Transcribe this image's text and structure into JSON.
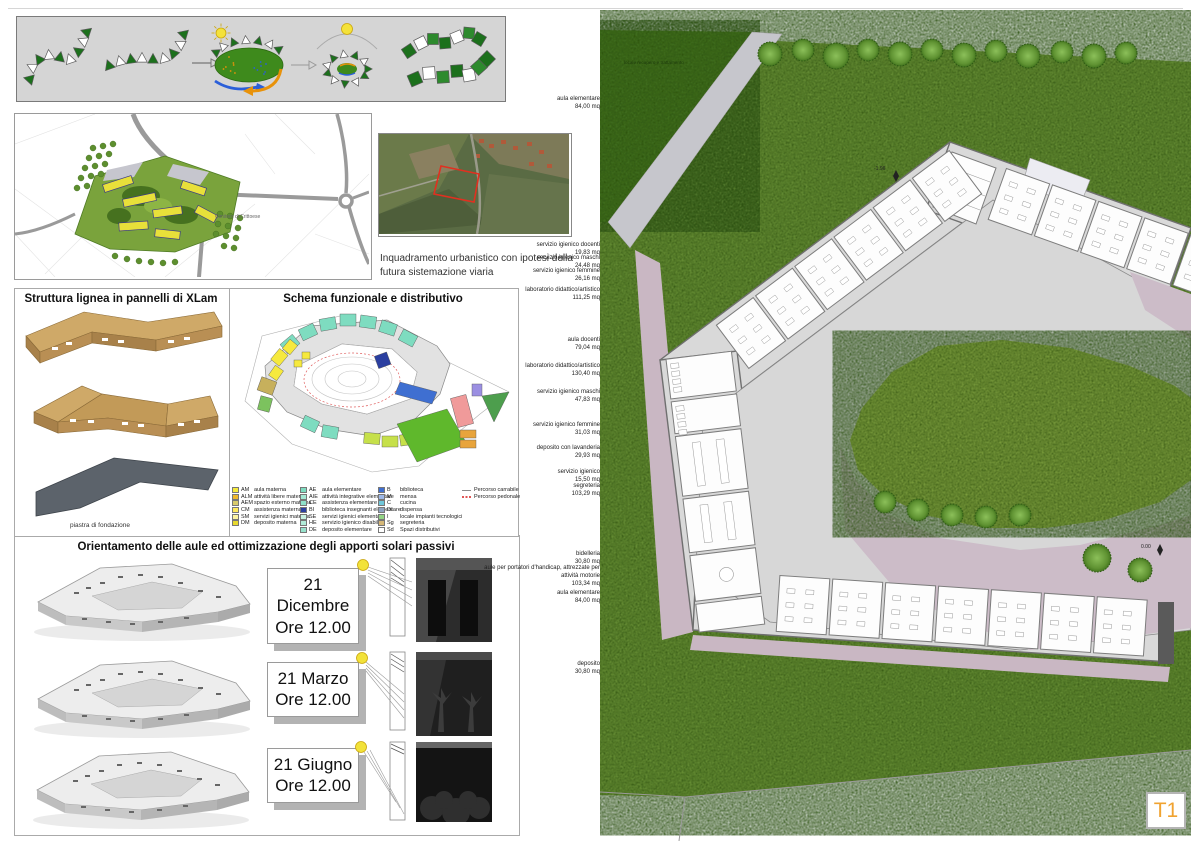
{
  "sheet": {
    "code": "T1"
  },
  "urban_map": {
    "place_label": "Cimitero di Crittoese"
  },
  "satellite": {
    "caption": "Inquadramento urbanistico con ipotesi della futura sistemazione viaria"
  },
  "xlam": {
    "title": "Struttura lignea in pannelli di XLam",
    "foundation_label": "piastra di fondazione"
  },
  "schema": {
    "title": "Schema funzionale e distributivo",
    "legend": {
      "materna": [
        {
          "code": "AM",
          "label": "aula materna",
          "color": "#f6ea3d"
        },
        {
          "code": "ALM",
          "label": "attività libere materna",
          "color": "#f0b92c"
        },
        {
          "code": "AEM",
          "label": "spazio esterno materna",
          "color": "#d9ca6a"
        },
        {
          "code": "CM",
          "label": "assistenza materna",
          "color": "#ffe95e"
        },
        {
          "code": "SM",
          "label": "servizi igienici materna",
          "color": "#fdf4a0"
        },
        {
          "code": "DM",
          "label": "deposito materna",
          "color": "#e8d92e"
        }
      ],
      "elementare": [
        {
          "code": "AE",
          "label": "aula elementare",
          "color": "#7edcc0"
        },
        {
          "code": "AIE",
          "label": "attività integrative elementare",
          "color": "#a5e8d4"
        },
        {
          "code": "CE",
          "label": "assistenza elementare",
          "color": "#8fe0c9"
        },
        {
          "code": "BI",
          "label": "biblioteca insegnanti elementare",
          "color": "#2b3fa0"
        },
        {
          "code": "SE",
          "label": "servizi igienici elementare",
          "color": "#c6f0e0"
        },
        {
          "code": "HE",
          "label": "servizio igienico disabile",
          "color": "#b2ecd9"
        },
        {
          "code": "DE",
          "label": "deposito elementare",
          "color": "#96e2cc"
        }
      ],
      "servizi": [
        {
          "code": "B",
          "label": "biblioteca",
          "color": "#3f6fd1"
        },
        {
          "code": "M",
          "label": "mensa",
          "color": "#9db8e8"
        },
        {
          "code": "C",
          "label": "cucina",
          "color": "#6fc6d9"
        },
        {
          "code": "Di",
          "label": "dispensa",
          "color": "#8fa3c0"
        },
        {
          "code": "I",
          "label": "locale impianti tecnologici",
          "color": "#92d483"
        },
        {
          "code": "Sg",
          "label": "segreteria",
          "color": "#d6b878"
        },
        {
          "code": "Sd",
          "label": "Spazi distributivi",
          "color": "#ffffff"
        }
      ],
      "percorsi": [
        {
          "label": "Percorso carrabile",
          "style": "solid",
          "color": "#8a8a8a"
        },
        {
          "label": "Percorso pedonale",
          "style": "dashed",
          "color": "#e05555"
        }
      ]
    }
  },
  "solar": {
    "title": "Orientamento delle aule ed ottimizzazione degli apporti solari passivi",
    "studies": [
      {
        "date": "21 Dicembre",
        "time": "Ore 12.00"
      },
      {
        "date": "21 Marzo",
        "time": "Ore 12.00"
      },
      {
        "date": "21 Giugno",
        "time": "Ore 12.00"
      }
    ]
  },
  "site_plan": {
    "annotations": {
      "level_upper": "-1.96",
      "level_plaza": "0.00",
      "water_area": "locale recupero e trattamento"
    },
    "labels": [
      {
        "name": "aula elementare",
        "area": "84,00 mq"
      },
      {
        "name": "servizio igienico docenti",
        "area": "19,83 mq"
      },
      {
        "name": "servizio igienico maschi",
        "area": "24,48 mq"
      },
      {
        "name": "servizio igienico femmine",
        "area": "26,16 mq"
      },
      {
        "name": "laboratorio didattico/artistico",
        "area": "111,25 mq"
      },
      {
        "name": "aula docenti",
        "area": "79,04 mq"
      },
      {
        "name": "laboratorio didattico/artistico",
        "area": "130,40 mq"
      },
      {
        "name": "servizio igienico maschi",
        "area": "47,83 mq"
      },
      {
        "name": "servizio igienico femmine",
        "area": "31,03 mq"
      },
      {
        "name": "deposito con lavanderia",
        "area": "29,93 mq"
      },
      {
        "name": "servizio igienico",
        "area": "15,50 mq"
      },
      {
        "name": "segreteria",
        "area": "103,29 mq"
      },
      {
        "name": "bidelleria",
        "area": "30,80 mq"
      },
      {
        "name": "aule per portatori d'handicap, attrezzate per attività motorie",
        "area": "103,34 mq"
      },
      {
        "name": "aula elementare",
        "area": "84,00 mq"
      },
      {
        "name": "deposito",
        "area": "30,80 mq"
      }
    ]
  }
}
